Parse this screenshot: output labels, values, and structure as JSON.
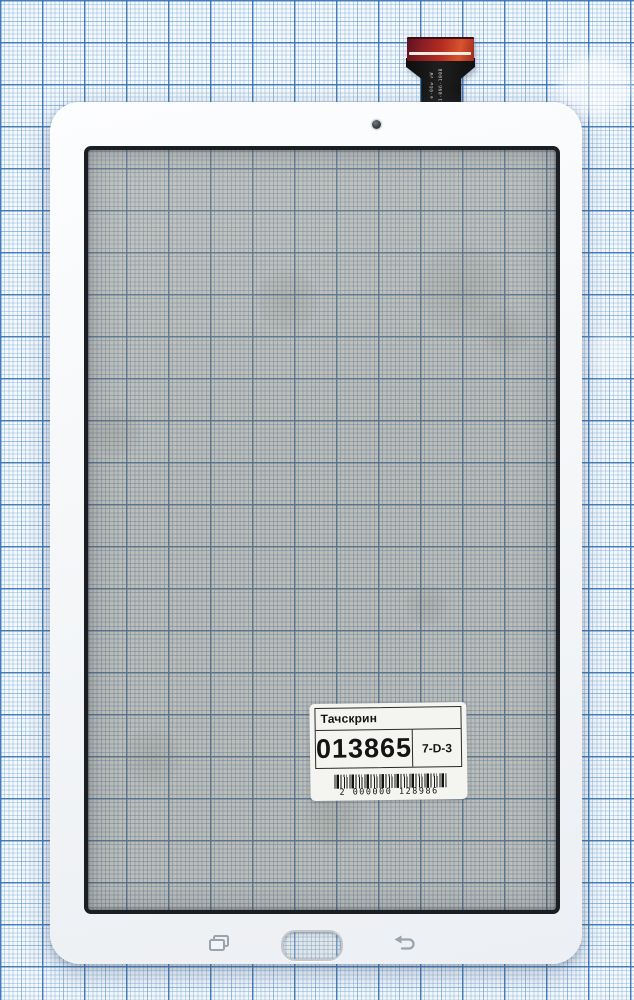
{
  "product_label": {
    "title": "Тачскрин",
    "part_number": "013865",
    "location_code": "7-D-3",
    "barcode_digits": "2 000000 128986"
  },
  "flex_cable": {
    "marking_line1": "⊕-06w  vW",
    "marking_line2": "60Z1-096-100B"
  },
  "icons": {
    "camera": "front-camera-dot",
    "recent_apps": "recent-apps-overlapping-rects",
    "home": "home-button-cutout",
    "back": "back-curved-arrow"
  },
  "colors": {
    "paper_fine_line": "#a9cce8",
    "paper_major_line": "#3f7cc0",
    "glass_tint": "#b0a98f",
    "bezel_white": "#f5f7f9",
    "screen_border": "#1b1e22",
    "connector_red": "#c23524",
    "ribbon_black": "#141414",
    "nav_icon_gray": "#9aa2ab"
  }
}
